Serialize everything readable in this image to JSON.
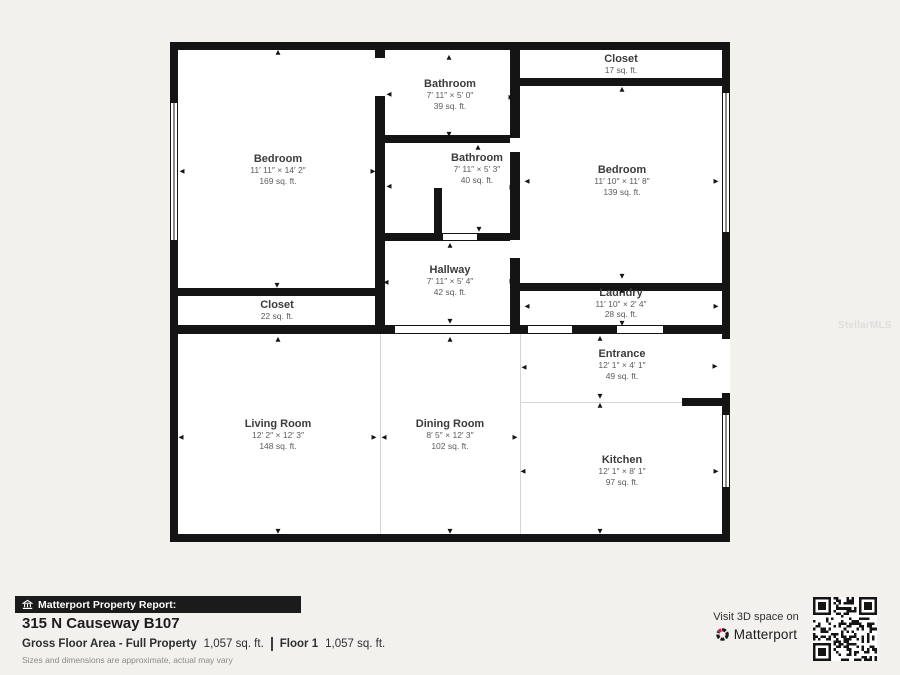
{
  "watermark": "StellarMLS",
  "icons": {
    "arrow_up": "▲",
    "arrow_down": "▼",
    "arrow_left": "◀",
    "arrow_right": "▶"
  },
  "colors": {
    "wall": "#141414",
    "background": "#f2f1ee",
    "banner_bg": "#1b1b1b",
    "brand_pink": "#e3175f"
  },
  "floorplan": {
    "rooms": [
      {
        "name": "Bedroom",
        "dims": "11′ 11″ × 14′ 2″",
        "area": "169 sq. ft."
      },
      {
        "name": "Bathroom",
        "dims": "7′ 11″ × 5′ 0″",
        "area": "39 sq. ft."
      },
      {
        "name": "Closet",
        "dims": "",
        "area": "17 sq. ft."
      },
      {
        "name": "Bathroom",
        "dims": "7′ 11″ × 5′ 3″",
        "area": "40 sq. ft."
      },
      {
        "name": "Bedroom",
        "dims": "11′ 10″ × 11′ 8″",
        "area": "139 sq. ft."
      },
      {
        "name": "Hallway",
        "dims": "7′ 11″ × 5′ 4″",
        "area": "42 sq. ft."
      },
      {
        "name": "Closet",
        "dims": "",
        "area": "22 sq. ft."
      },
      {
        "name": "Laundry",
        "dims": "11′ 10″ × 2′ 4″",
        "area": "28 sq. ft."
      },
      {
        "name": "Entrance",
        "dims": "12′ 1″ × 4′ 1″",
        "area": "49 sq. ft."
      },
      {
        "name": "Living Room",
        "dims": "12′ 2″ × 12′ 3″",
        "area": "148 sq. ft."
      },
      {
        "name": "Dining Room",
        "dims": "8′ 5″ × 12′ 3″",
        "area": "102 sq. ft."
      },
      {
        "name": "Kitchen",
        "dims": "12′ 1″ × 8′ 1″",
        "area": "97 sq. ft."
      }
    ]
  },
  "report": {
    "banner_label": "Matterport Property Report:",
    "address": "315 N Causeway B107",
    "gross_label": "Gross Floor Area - Full Property",
    "gross_value": "1,057 sq. ft.",
    "floor_label": "Floor 1",
    "floor_value": "1,057 sq. ft.",
    "disclaimer": "Sizes and dimensions are approximate, actual may vary"
  },
  "cta": {
    "visit_label": "Visit 3D space on",
    "brand": "Matterport"
  }
}
